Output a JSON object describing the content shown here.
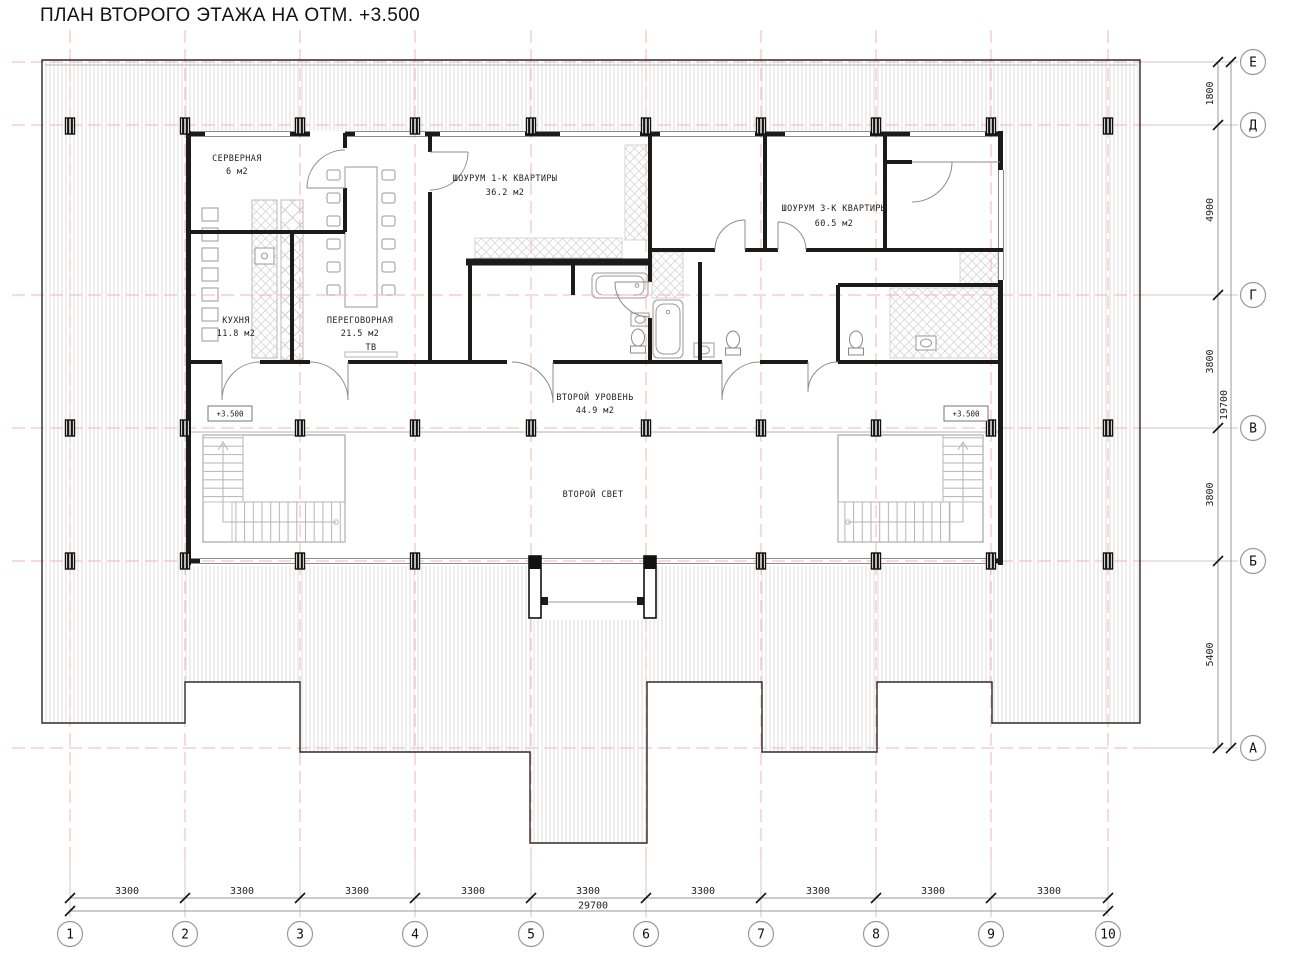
{
  "title": "ПЛАН ВТОРОГО ЭТАЖА НА ОТМ. +3.500",
  "rooms": {
    "server": {
      "name": "СЕРВЕРНАЯ",
      "area": "6 м2"
    },
    "kitchen": {
      "name": "КУХНЯ",
      "area": "11.8 м2"
    },
    "meeting": {
      "name": "ПЕРЕГОВОРНАЯ",
      "area": "21.5 м2"
    },
    "meeting_tv": "ТВ",
    "showroom1": {
      "name": "ШОУРУМ 1-К КВАРТИРЫ",
      "area": "36.2 м2"
    },
    "showroom3": {
      "name": "ШОУРУМ 3-К КВАРТИРЫ",
      "area": "60.5 м2"
    },
    "second_level": {
      "name": "ВТОРОЙ УРОВЕНЬ",
      "area": "44.9 м2"
    },
    "second_light": {
      "name": "ВТОРОЙ СВЕТ"
    }
  },
  "elevation": {
    "left": "+3.500",
    "right": "+3.500"
  },
  "axes": {
    "columns": {
      "labels": [
        "1",
        "2",
        "3",
        "4",
        "5",
        "6",
        "7",
        "8",
        "9",
        "10"
      ]
    },
    "rows": {
      "labels": [
        "Е",
        "Д",
        "Г",
        "В",
        "Б",
        "А"
      ]
    }
  },
  "dimensions": {
    "bottom_segments": [
      "3300",
      "3300",
      "3300",
      "3300",
      "3300",
      "3300",
      "3300",
      "3300",
      "3300"
    ],
    "bottom_total": "29700",
    "right_segments": [
      "1800",
      "4900",
      "3800",
      "3800",
      "5400"
    ],
    "right_total": "19700"
  },
  "colors": {
    "grid": "#f3b6b6",
    "walls": "#1b1b1b",
    "hatch": "#dedede",
    "accent_thin": "#9a9a9a"
  }
}
